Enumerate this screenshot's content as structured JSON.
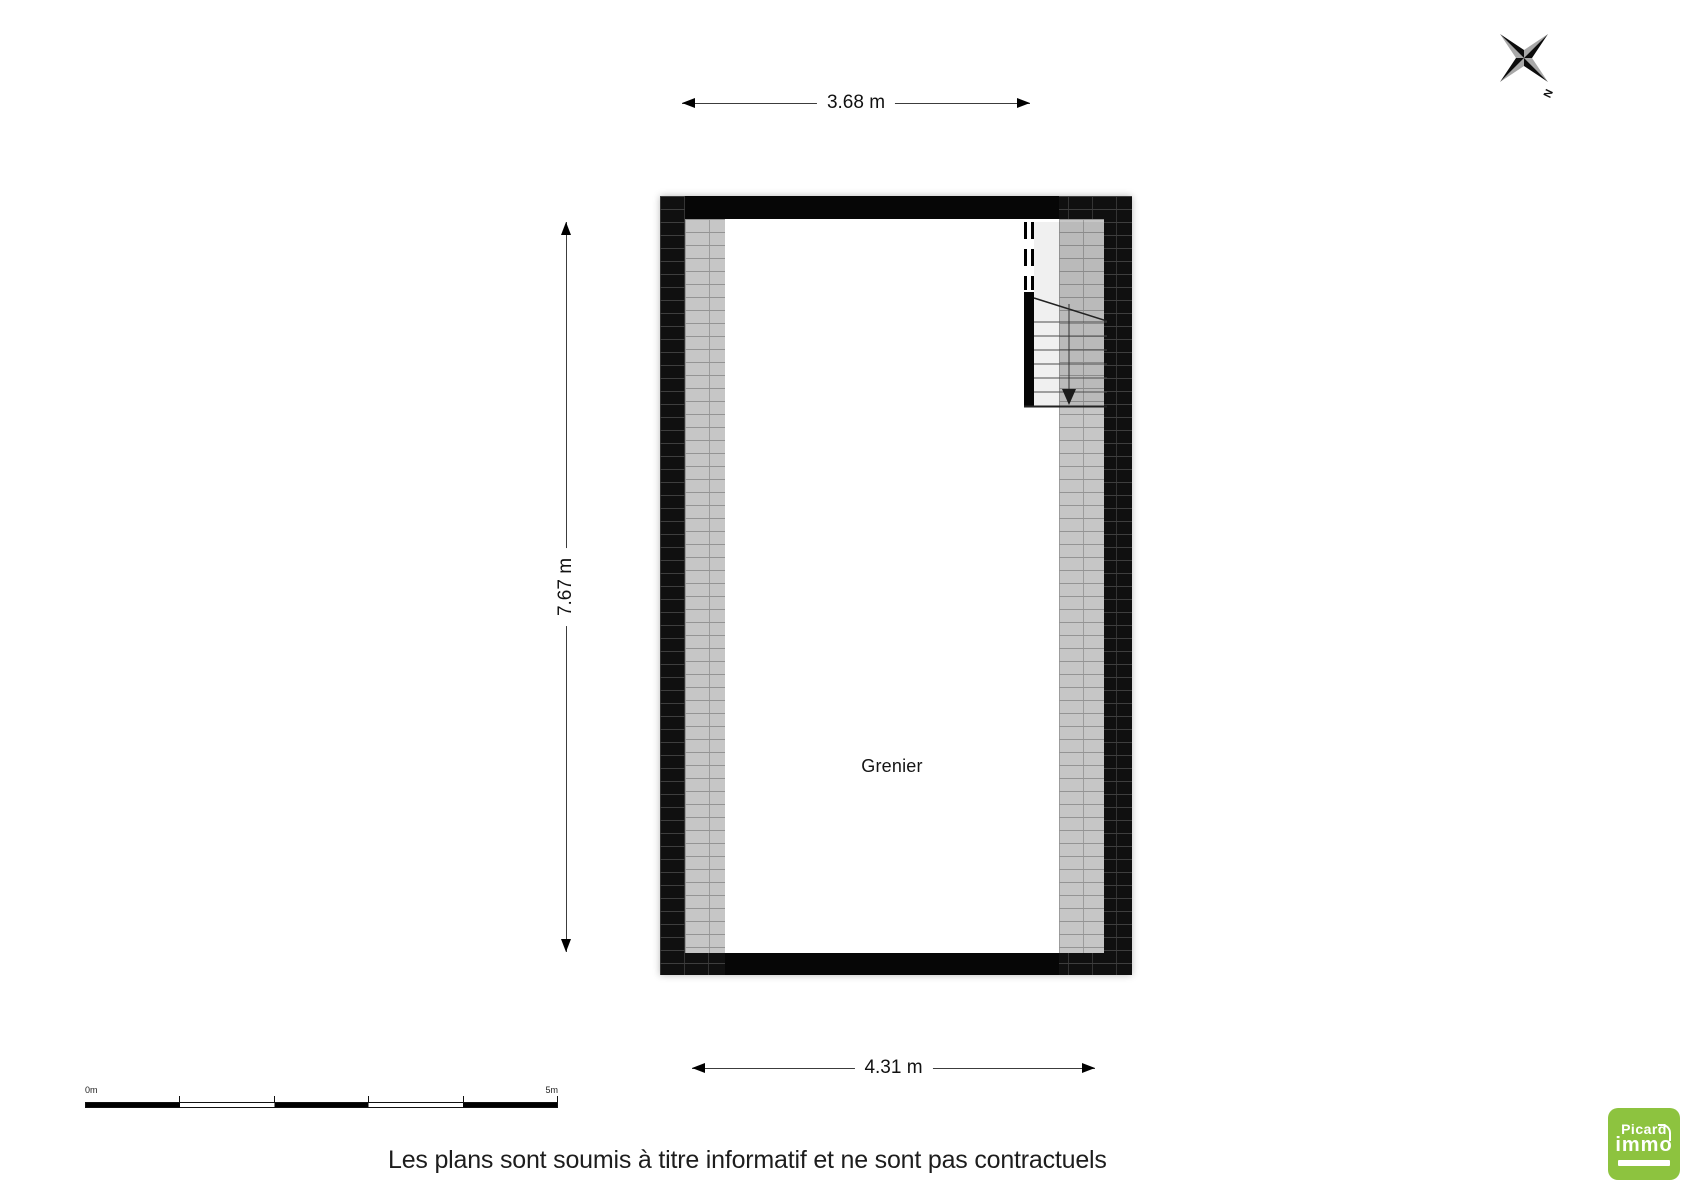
{
  "compass": {
    "north_label": "N"
  },
  "dimensions": {
    "top": "3.68 m",
    "left": "7.67 m",
    "bottom": "4.31 m"
  },
  "room": {
    "label": "Grenier"
  },
  "scale_bar": {
    "start_label": "0m",
    "end_label": "5m"
  },
  "footer": {
    "disclaimer": "Les plans sont soumis à titre informatif et ne sont pas contractuels"
  },
  "logo": {
    "line1": "Picard",
    "line2": "immo"
  },
  "colors": {
    "wall_dark": "#101010",
    "wall_light": "#c6c6c6",
    "logo_green": "#8dc33f",
    "line": "#1a1a1a"
  }
}
